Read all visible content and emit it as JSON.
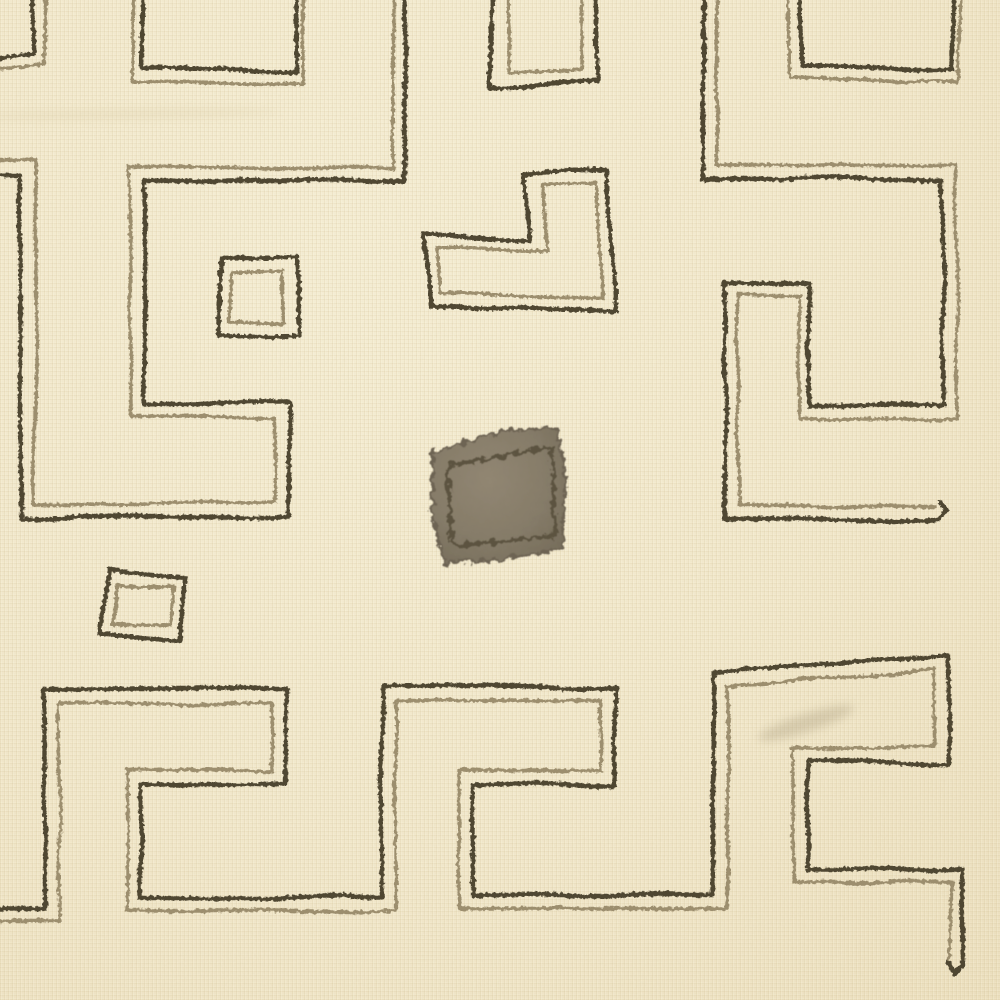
{
  "artwork": {
    "description": "Kuba-style raffia textile with cream ground, hand-stitched double-outline geometric maze motifs and one solid appliqued patch",
    "canvas": {
      "width": 1000,
      "height": 1000
    }
  },
  "palette": {
    "background": "#f2e8cb",
    "dark_thread": "#4f4632",
    "light_thread": "#9c8e6e",
    "patch_rim": "#6d6353",
    "patch_stitch": "#5c5340",
    "crease": "#d9cba6",
    "smudge": "#9f9172"
  },
  "stitch": {
    "dash_dark": "17 1.5 23 2 12 1.5",
    "dash_light": "15 2 21 1.5",
    "width_dark": 4.4,
    "width_light": 3.4
  },
  "shapes": [
    {
      "name": "crease-top-left",
      "type": "ellipse",
      "cx": 130,
      "cy": 114,
      "rx": 150,
      "ry": 5,
      "rot": -1,
      "fill": "crease",
      "opacity": 0.28,
      "filter": "soft"
    },
    {
      "name": "smudge-bottom-right",
      "type": "ellipse",
      "cx": 806,
      "cy": 723,
      "rx": 50,
      "ry": 9,
      "rot": -18,
      "fill": "smudge",
      "opacity": 0.3,
      "filter": "soft"
    },
    {
      "name": "center-patch",
      "type": "polygon",
      "closed": true,
      "fill": "patch_gradient",
      "stroke": "patch_rim",
      "width": 3,
      "filter": "fuzz",
      "points": [
        [
          433,
          453
        ],
        [
          500,
          431
        ],
        [
          557,
          428
        ],
        [
          566,
          477
        ],
        [
          562,
          548
        ],
        [
          498,
          560
        ],
        [
          445,
          563
        ],
        [
          432,
          516
        ]
      ]
    },
    {
      "name": "center-patch-stitch",
      "type": "polygon",
      "closed": true,
      "stroke": "patch_stitch",
      "width": 4,
      "filter": "fuzz",
      "points": [
        [
          447,
          466
        ],
        [
          552,
          447
        ],
        [
          555,
          536
        ],
        [
          452,
          546
        ]
      ]
    },
    {
      "name": "fragment-topleft-light-stitch",
      "type": "polyline",
      "role": "light",
      "points": [
        [
          46,
          -8
        ],
        [
          45,
          65
        ],
        [
          -8,
          70
        ]
      ]
    },
    {
      "name": "rect-top-light-stitch",
      "type": "polyline",
      "role": "light",
      "points": [
        [
          133,
          -8
        ],
        [
          134,
          81
        ],
        [
          305,
          85
        ],
        [
          304,
          -8
        ]
      ]
    },
    {
      "name": "rect-topmiddle-light-stitch",
      "type": "polyline",
      "role": "light",
      "points": [
        [
          507,
          -8
        ],
        [
          507,
          75
        ],
        [
          582,
          69
        ],
        [
          582,
          -8
        ]
      ]
    },
    {
      "name": "rect-topright-light-stitch",
      "type": "polyline",
      "role": "light",
      "points": [
        [
          789,
          -8
        ],
        [
          790,
          78
        ],
        [
          958,
          82
        ],
        [
          960,
          -8
        ]
      ]
    },
    {
      "name": "l-motif-light-stitch",
      "type": "polygon",
      "closed": true,
      "role": "light",
      "points": [
        [
          543,
          185
        ],
        [
          597,
          184
        ],
        [
          602,
          299
        ],
        [
          442,
          294
        ],
        [
          438,
          248
        ],
        [
          547,
          252
        ]
      ]
    },
    {
      "name": "small-square-upper-light-stitch",
      "type": "polygon",
      "closed": true,
      "role": "light",
      "points": [
        [
          231,
          273
        ],
        [
          282,
          271
        ],
        [
          284,
          324
        ],
        [
          228,
          323
        ]
      ]
    },
    {
      "name": "small-square-lower-light-stitch",
      "type": "polygon",
      "closed": true,
      "role": "light",
      "points": [
        [
          116,
          584
        ],
        [
          174,
          587
        ],
        [
          172,
          626
        ],
        [
          113,
          624
        ]
      ]
    },
    {
      "name": "left-meander-light-stitch",
      "type": "polyline",
      "role": "light",
      "points": [
        [
          393,
          -8
        ],
        [
          393,
          168
        ],
        [
          130,
          168
        ],
        [
          130,
          417
        ],
        [
          275,
          417
        ],
        [
          275,
          503
        ],
        [
          35,
          503
        ],
        [
          35,
          161
        ],
        [
          -8,
          161
        ]
      ]
    },
    {
      "name": "right-meander-light-stitch",
      "type": "polyline",
      "role": "light",
      "points": [
        [
          717,
          -8
        ],
        [
          717,
          165
        ],
        [
          957,
          165
        ],
        [
          957,
          419
        ],
        [
          799,
          419
        ],
        [
          799,
          295
        ],
        [
          738,
          295
        ],
        [
          738,
          505
        ],
        [
          936,
          505
        ]
      ]
    },
    {
      "name": "bottom-meander-light-stitch",
      "type": "polyline",
      "role": "light",
      "points": [
        [
          -8,
          921
        ],
        [
          59,
          921
        ],
        [
          59,
          703
        ],
        [
          272,
          703
        ],
        [
          272,
          770
        ],
        [
          127,
          770
        ],
        [
          127,
          911
        ],
        [
          396,
          911
        ],
        [
          396,
          701
        ],
        [
          601,
          701
        ],
        [
          601,
          770
        ],
        [
          459,
          770
        ],
        [
          459,
          909
        ],
        [
          727,
          909
        ],
        [
          727,
          687
        ],
        [
          934,
          669
        ],
        [
          934,
          748
        ],
        [
          794,
          748
        ],
        [
          794,
          882
        ],
        [
          951,
          882
        ],
        [
          951,
          962
        ]
      ]
    },
    {
      "name": "fragment-topleft-dark-stitch",
      "type": "polyline",
      "role": "dark",
      "points": [
        [
          33,
          -8
        ],
        [
          31,
          52
        ],
        [
          -8,
          58
        ]
      ]
    },
    {
      "name": "rect-top-dark-stitch",
      "type": "polyline",
      "role": "dark",
      "points": [
        [
          143,
          -8
        ],
        [
          142,
          68
        ],
        [
          297,
          73
        ],
        [
          298,
          -8
        ]
      ]
    },
    {
      "name": "rect-topmiddle-dark-stitch",
      "type": "polyline",
      "role": "dark",
      "points": [
        [
          493,
          -8
        ],
        [
          491,
          89
        ],
        [
          597,
          81
        ],
        [
          595,
          -8
        ]
      ]
    },
    {
      "name": "rect-topright-dark-stitch",
      "type": "polyline",
      "role": "dark",
      "points": [
        [
          800,
          -8
        ],
        [
          801,
          64
        ],
        [
          953,
          69
        ],
        [
          953,
          -8
        ]
      ]
    },
    {
      "name": "l-motif-dark-stitch",
      "type": "polygon",
      "closed": true,
      "role": "dark",
      "points": [
        [
          523,
          173
        ],
        [
          606,
          171
        ],
        [
          616,
          312
        ],
        [
          431,
          306
        ],
        [
          425,
          234
        ],
        [
          529,
          240
        ]
      ]
    },
    {
      "name": "small-square-upper-dark-stitch",
      "type": "polygon",
      "closed": true,
      "role": "dark",
      "points": [
        [
          222,
          260
        ],
        [
          297,
          257
        ],
        [
          300,
          335
        ],
        [
          217,
          336
        ]
      ]
    },
    {
      "name": "small-square-lower-dark-stitch",
      "type": "polygon",
      "closed": true,
      "role": "dark",
      "points": [
        [
          110,
          569
        ],
        [
          187,
          577
        ],
        [
          184,
          640
        ],
        [
          100,
          634
        ]
      ]
    },
    {
      "name": "left-meander-dark-stitch",
      "type": "polyline",
      "role": "dark",
      "points": [
        [
          405,
          -8
        ],
        [
          405,
          181
        ],
        [
          144,
          181
        ],
        [
          144,
          403
        ],
        [
          289,
          403
        ],
        [
          289,
          517
        ],
        [
          21,
          517
        ],
        [
          21,
          175
        ],
        [
          -8,
          175
        ]
      ]
    },
    {
      "name": "right-meander-dark-stitch",
      "type": "polyline",
      "role": "dark",
      "points": [
        [
          703,
          -8
        ],
        [
          703,
          179
        ],
        [
          943,
          179
        ],
        [
          943,
          405
        ],
        [
          810,
          405
        ],
        [
          810,
          282
        ],
        [
          725,
          282
        ],
        [
          725,
          519
        ],
        [
          938,
          519
        ]
      ]
    },
    {
      "name": "right-meander-end-cap",
      "type": "polyline",
      "role": "cap",
      "points": [
        [
          938,
          520
        ],
        [
          946,
          512
        ],
        [
          939,
          504
        ]
      ]
    },
    {
      "name": "bottom-meander-dark-stitch",
      "type": "polyline",
      "role": "dark",
      "points": [
        [
          -8,
          909
        ],
        [
          45,
          909
        ],
        [
          45,
          689
        ],
        [
          286,
          689
        ],
        [
          286,
          784
        ],
        [
          141,
          784
        ],
        [
          141,
          898
        ],
        [
          382,
          898
        ],
        [
          382,
          687
        ],
        [
          615,
          687
        ],
        [
          615,
          784
        ],
        [
          473,
          784
        ],
        [
          473,
          895
        ],
        [
          713,
          895
        ],
        [
          713,
          673
        ],
        [
          948,
          654
        ],
        [
          948,
          762
        ],
        [
          808,
          762
        ],
        [
          808,
          870
        ],
        [
          963,
          870
        ],
        [
          963,
          966
        ]
      ]
    },
    {
      "name": "bottom-meander-end-cap",
      "type": "polyline",
      "role": "cap",
      "points": [
        [
          963,
          966
        ],
        [
          957,
          973
        ],
        [
          951,
          962
        ]
      ]
    }
  ]
}
